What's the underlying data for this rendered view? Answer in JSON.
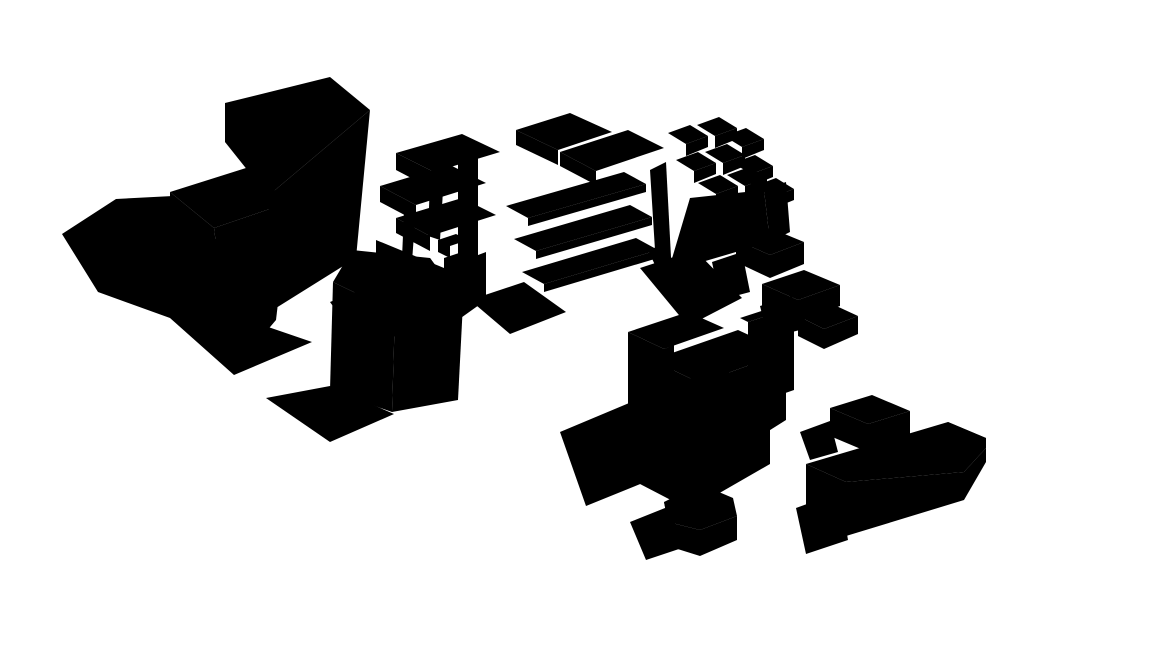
{
  "scene": {
    "description": "Axonometric architectural site-massing rendering: white block buildings with gray cast shadows, curving paths, a pond, a zigzag hatched embankment and palm trees",
    "background_color": "#ffffff",
    "colors": {
      "outline": "#000000",
      "face_white": "#ffffff",
      "face_shade": "#a9a9a9",
      "ground_shadow": "#9e9e9e",
      "palm_frond": "#2f7a5c",
      "palm_frond_light": "#63b58e",
      "palm_trunk": "#a6a43f",
      "palm_trunk_dark": "#6d6b28"
    },
    "buildings": [
      "left-tower",
      "terrace-block-west",
      "terrace-block-east",
      "courtyard-castle",
      "stepped-ziggurat",
      "pentagon-tower",
      "central-slab-cluster",
      "gable-house",
      "row-houses",
      "l-shaped-building"
    ],
    "palm_trees": [
      {
        "x": 160,
        "y": 272,
        "s": 1.0
      },
      {
        "x": 263,
        "y": 373,
        "s": 1.05
      },
      {
        "x": 360,
        "y": 455,
        "s": 0.95
      },
      {
        "x": 404,
        "y": 160,
        "s": 0.95
      },
      {
        "x": 459,
        "y": 131,
        "s": 0.95
      },
      {
        "x": 513,
        "y": 280,
        "s": 1.0
      },
      {
        "x": 534,
        "y": 389,
        "s": 1.0
      },
      {
        "x": 616,
        "y": 500,
        "s": 0.95
      },
      {
        "x": 686,
        "y": 150,
        "s": 0.45
      },
      {
        "x": 878,
        "y": 391,
        "s": 0.95
      },
      {
        "x": 806,
        "y": 506,
        "s": 0.9
      }
    ],
    "row_houses": [
      {
        "x": 443,
        "y": 413,
        "len": 150
      },
      {
        "x": 480,
        "y": 452,
        "len": 195
      },
      {
        "x": 500,
        "y": 497,
        "len": 192
      },
      {
        "x": 556,
        "y": 540,
        "len": 180
      },
      {
        "x": 584,
        "y": 582,
        "len": 150
      }
    ],
    "zigzag_band": {
      "x1": 352,
      "y1": 484,
      "x2": 518,
      "y2": 640,
      "nx": -11,
      "ny": 11,
      "teeth": 20
    },
    "tree_shadow": {
      "dots": 16,
      "spread_x": 34,
      "spread_y": 12
    }
  }
}
